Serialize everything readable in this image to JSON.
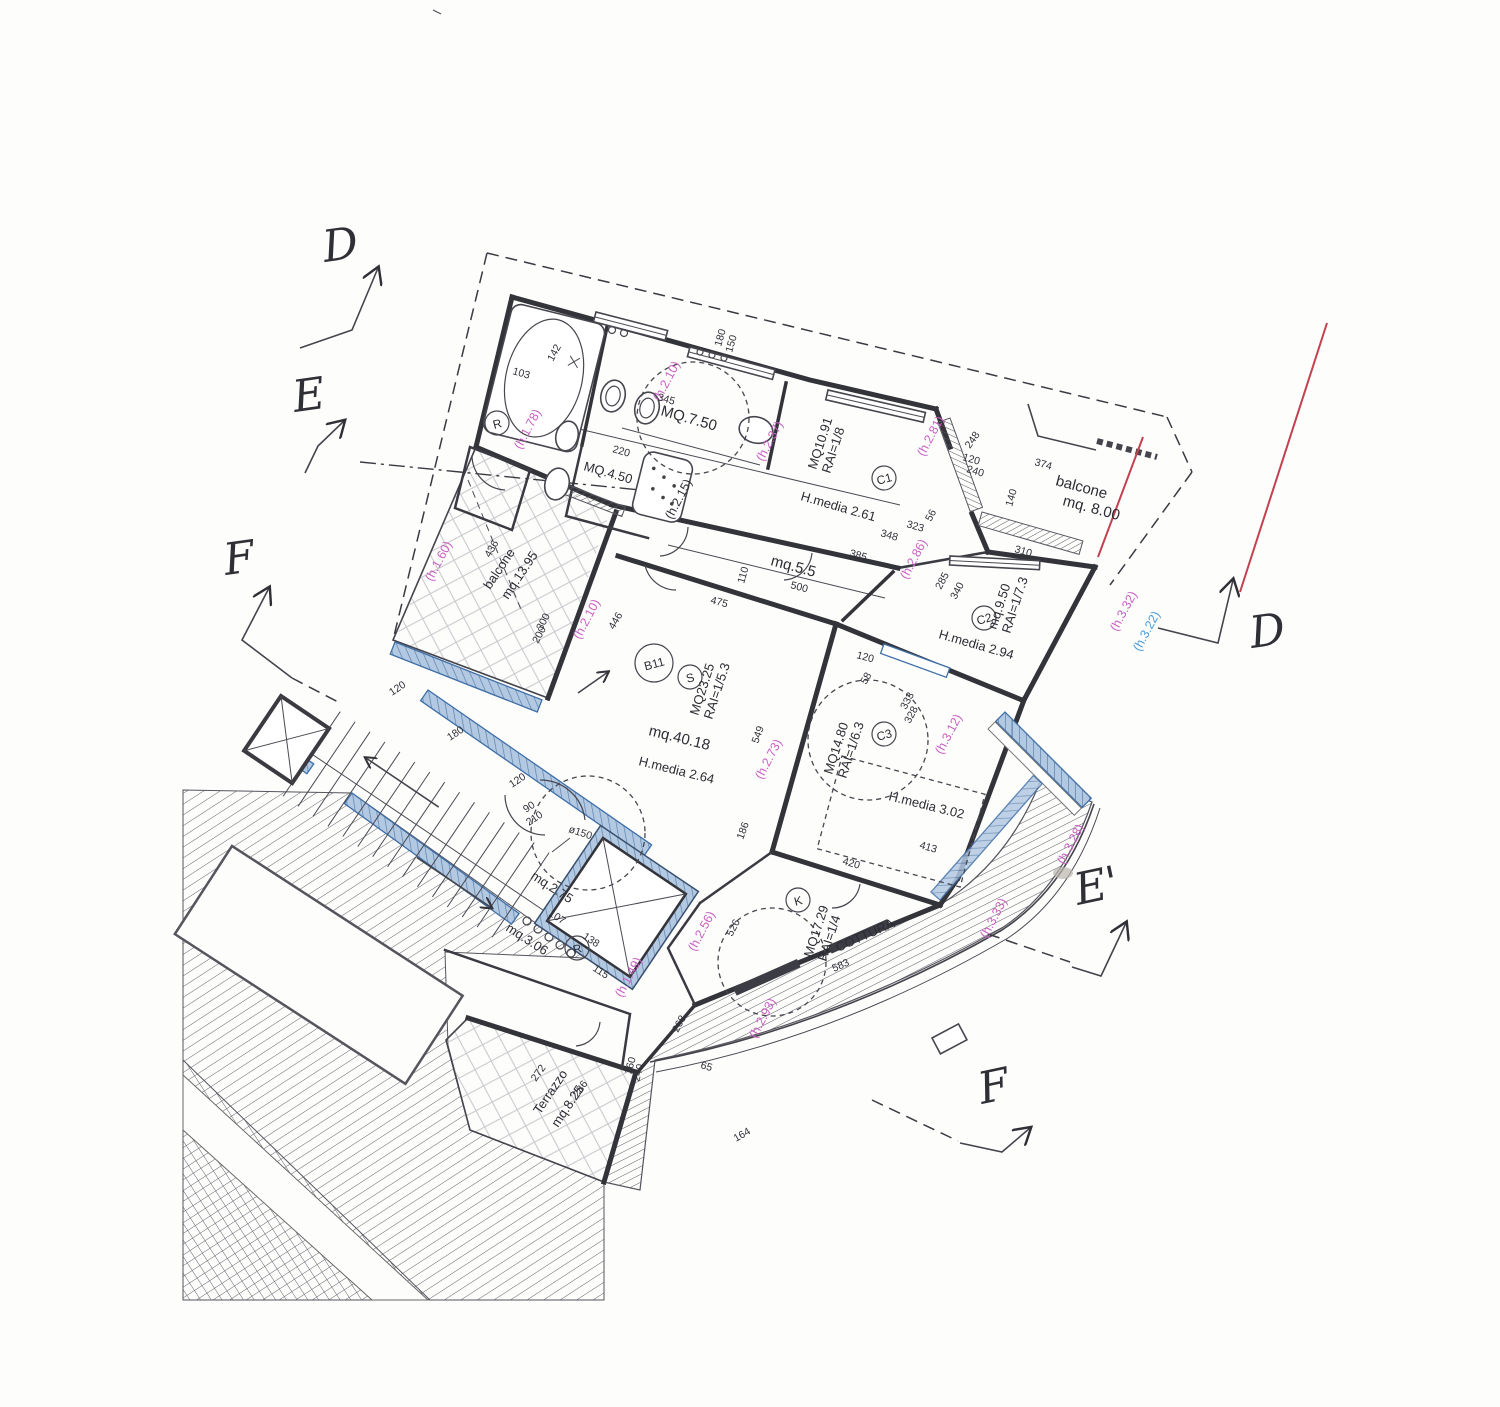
{
  "colors": {
    "pink_note": "#c95fc2",
    "blue_note": "#4a9bd5",
    "red_line": "#c3404f",
    "railing": "#b3c9e2",
    "wall": "#33333a"
  },
  "markers": {
    "d_left": "D",
    "e_left": "E",
    "f_left": "F",
    "d_right": "D",
    "e_prime": "E'",
    "f_bottom": "F"
  },
  "labels": {
    "bath_main_area": "MQ.7.50",
    "bath_small_area": "MQ.4.50",
    "bed1_area": "MQ10.91",
    "bed1_rai": "RAI=1/8",
    "bed1_h": "H.media 2.61",
    "balcone_top_name": "balcone",
    "balcone_top_area": "mq. 8.00",
    "balcone_left_name": "balcone",
    "balcone_left_area": "mq.13.95",
    "terrace_area": "mq.9.50",
    "terrace_rai": "RAI=1/7.3",
    "terrace_h": "H.media 2.94",
    "hall_area": "mq.5.5",
    "unit_code": "B11",
    "living_s": "S",
    "living_sub": "MQ23.25",
    "living_rai": "RAI=1/5.3",
    "living_area": "mq.40.18",
    "living_h": "H.media 2.64",
    "bed2_area": "MQ14.80",
    "bed2_rai": "RAI=1/6.3",
    "bed2_h": "H.media 3.02",
    "kitchen_k": "K",
    "kitchen_area": "MQ17.29",
    "kitchen_rai": "RAI=1/4",
    "kitchen_name": "COTTURA",
    "lobby_area": "mq.2.75",
    "hall2_area": "mq.3.06",
    "terrazzo_name": "Terrazzo",
    "terrazzo_area": "mq.8.25",
    "r1": "R",
    "r2": "R",
    "c1": "C1",
    "c2": "C2",
    "c3": "C3",
    "diam150": "ø150"
  },
  "heights": {
    "h178": "(h.1.78)",
    "h210a": "(h.2.10)",
    "h210b": "(h.2.10)",
    "h160": "(h.1.60)",
    "h215": "(h.2.15)",
    "h237": "(h.2.37)",
    "h281": "(h.2.81)",
    "h286": "(h.2.86)",
    "h273": "(h.2.73)",
    "h312": "(h.3.12)",
    "h332": "(h.3.32)",
    "h322": "(h.3.22)",
    "h328": "(h.3.28)",
    "h333": "(h.3.33)",
    "h256": "(h.2.56)",
    "h149": "(h.1.49)",
    "h293": "(h.2.93)"
  },
  "dims": {
    "d345": "345",
    "d348": "348",
    "d323": "323",
    "d385": "385",
    "d500": "500",
    "d110": "110",
    "d475": "475",
    "d549": "549",
    "d446": "446",
    "d186": "186",
    "d120a": "120",
    "d58": "58",
    "d436": "436",
    "d300": "300",
    "d200": "200",
    "d220": "220",
    "d142": "142",
    "d103": "103",
    "d180a": "180",
    "d150a": "150",
    "d374": "374",
    "d248": "248",
    "d120b": "120",
    "d240a": "240",
    "d140": "140",
    "d310": "310",
    "d285": "285",
    "d340": "340",
    "d333": "333",
    "d328": "328",
    "d420": "420",
    "d413": "413",
    "d583": "583",
    "d526": "526",
    "d268": "268",
    "d65": "65",
    "d107": "107",
    "d138": "138",
    "d115": "115",
    "d272": "272",
    "d286": "286",
    "d160": "160",
    "d240b": "240",
    "d164": "164",
    "d120c": "120",
    "d180b": "180",
    "d120d": "120",
    "d90": "90",
    "d210": "210",
    "d56": "56"
  }
}
